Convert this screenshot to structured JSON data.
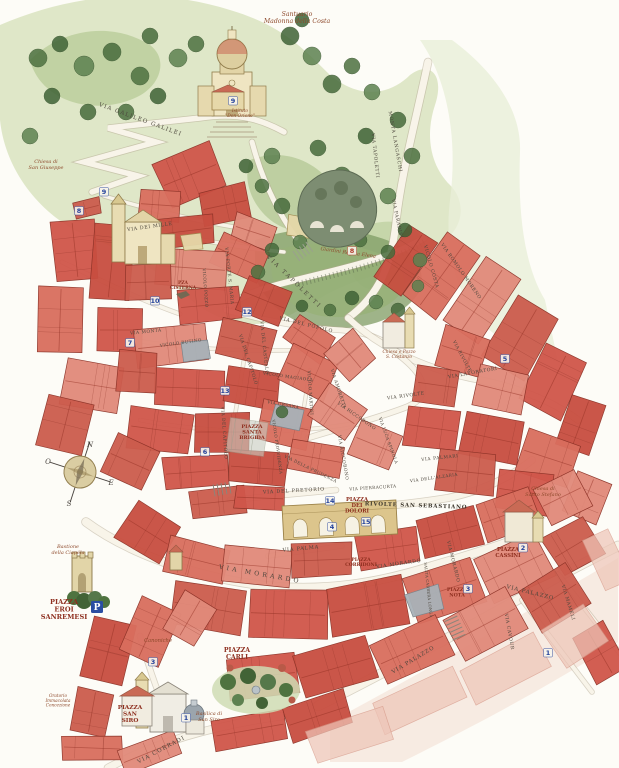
{
  "map": {
    "compass": {
      "n": "N",
      "e": "E",
      "s": "S",
      "w": "O"
    },
    "parking": {
      "label": "P",
      "x": 97,
      "y": 607
    },
    "colors": {
      "building_red": "#d0564a",
      "building_outline": "#8c3227",
      "hill_green": "#b9cc96",
      "tree_green": "#4d7140",
      "road_cream": "#f8f4e9",
      "marker_blue": "#24439c",
      "marker_red": "#b23a2a",
      "piazza_red": "#8e2f1f",
      "landmark_brown": "#8e4a2c",
      "paper": "#fdfcf7"
    },
    "streets": [
      {
        "name": "VIA GALILEO GALILEI",
        "x": 140,
        "y": 121,
        "rot": 20,
        "size": 5.6,
        "ls": 1.2
      },
      {
        "name": "MONTA LANGASCHI",
        "x": 394,
        "y": 142,
        "rot": 80,
        "size": 4.6,
        "ls": 0.8
      },
      {
        "name": "VIA TAPOLETTI",
        "x": 374,
        "y": 156,
        "rot": 84,
        "size": 4.6,
        "ls": 0.6
      },
      {
        "name": "VIA PARADISI",
        "x": 396,
        "y": 219,
        "rot": 78,
        "size": 4.6,
        "ls": 0.6
      },
      {
        "name": "VIA DEI MILLE",
        "x": 150,
        "y": 228,
        "rot": -8,
        "size": 4.8,
        "ls": 0.6
      },
      {
        "name": "VIA TAPOLETTI",
        "x": 293,
        "y": 283,
        "rot": 44,
        "size": 5.6,
        "ls": 2.2
      },
      {
        "name": "VIA DEL POPOLO",
        "x": 306,
        "y": 326,
        "rot": 14,
        "size": 4.8,
        "ls": 0.8
      },
      {
        "name": "VIA PORTE S. MARIA",
        "x": 228,
        "y": 276,
        "rot": 84,
        "size": 4.4,
        "ls": 0.5
      },
      {
        "name": "VICOLO POZZO",
        "x": 204,
        "y": 288,
        "rot": 86,
        "size": 4.2,
        "ls": 0.4
      },
      {
        "name": "VIA MONTÀ",
        "x": 146,
        "y": 333,
        "rot": -6,
        "size": 4.4,
        "ls": 0.5
      },
      {
        "name": "VICOLO BUTINO",
        "x": 181,
        "y": 344,
        "rot": -8,
        "size": 4.2,
        "ls": 0.4
      },
      {
        "name": "VIA DEL CASTELLO",
        "x": 263,
        "y": 348,
        "rot": 84,
        "size": 4.4,
        "ls": 0.5
      },
      {
        "name": "VIA DEL CAPITOLO",
        "x": 247,
        "y": 360,
        "rot": 72,
        "size": 4.4,
        "ls": 0.5
      },
      {
        "name": "VIA DEL CAPITOLO",
        "x": 223,
        "y": 433,
        "rot": 86,
        "size": 4.4,
        "ls": 0.5
      },
      {
        "name": "VICOLO MAGIAOLA",
        "x": 288,
        "y": 378,
        "rot": 8,
        "size": 4.2,
        "ls": 0.5
      },
      {
        "name": "VIA AMORETTI",
        "x": 337,
        "y": 389,
        "rot": 72,
        "size": 4.4,
        "ls": 0.5
      },
      {
        "name": "VICOLO MARTINI",
        "x": 309,
        "y": 393,
        "rot": 86,
        "size": 4.2,
        "ls": 0.4
      },
      {
        "name": "VIA URSANA",
        "x": 283,
        "y": 406,
        "rot": 10,
        "size": 4.2,
        "ls": 0.4
      },
      {
        "name": "VIA RIVOLTE",
        "x": 406,
        "y": 397,
        "rot": -8,
        "size": 4.6,
        "ls": 0.6
      },
      {
        "name": "VIA RIVOLTE",
        "x": 461,
        "y": 357,
        "rot": 62,
        "size": 4.4,
        "ls": 0.5
      },
      {
        "name": "VIA LAVORATORI",
        "x": 473,
        "y": 374,
        "rot": -10,
        "size": 4.6,
        "ls": 0.6
      },
      {
        "name": "VICOLO COSTA",
        "x": 430,
        "y": 267,
        "rot": 74,
        "size": 4.6,
        "ls": 0.6
      },
      {
        "name": "VIA ROMOLO MORENO",
        "x": 460,
        "y": 272,
        "rot": 55,
        "size": 4.6,
        "ls": 0.6
      },
      {
        "name": "VIA RICCOBONO",
        "x": 356,
        "y": 417,
        "rot": 35,
        "size": 4.4,
        "ls": 0.5
      },
      {
        "name": "VIA RICCOBONO",
        "x": 342,
        "y": 458,
        "rot": 80,
        "size": 4.4,
        "ls": 0.5
      },
      {
        "name": "VIA PALMARI",
        "x": 440,
        "y": 459,
        "rot": -6,
        "size": 4.4,
        "ls": 0.6
      },
      {
        "name": "VIA DELL'ALZARIA",
        "x": 434,
        "y": 479,
        "rot": -8,
        "size": 4.2,
        "ls": 0.4
      },
      {
        "name": "VIA PIERRACURTA",
        "x": 373,
        "y": 489,
        "rot": -4,
        "size": 4.2,
        "ls": 0.4
      },
      {
        "name": "VIA DELLA PRUDENZA",
        "x": 310,
        "y": 470,
        "rot": 26,
        "size": 4.2,
        "ls": 0.4
      },
      {
        "name": "VICOLO PROVVIDENZA",
        "x": 276,
        "y": 447,
        "rot": 82,
        "size": 4.0,
        "ls": 0.3
      },
      {
        "name": "VIA LUCA SPINOLA",
        "x": 387,
        "y": 441,
        "rot": 70,
        "size": 4.2,
        "ls": 0.4
      },
      {
        "name": "VIA DEL PRETORIO",
        "x": 294,
        "y": 492,
        "rot": -3,
        "size": 4.8,
        "ls": 0.8
      },
      {
        "name": "RIVOLTE SAN SEBASTIANO",
        "x": 416,
        "y": 507,
        "rot": 2,
        "size": 5.4,
        "ls": 0.8,
        "bold": true
      },
      {
        "name": "VIA PALMA",
        "x": 301,
        "y": 550,
        "rot": -5,
        "size": 5.0,
        "ls": 0.8
      },
      {
        "name": "VIA MORARDO",
        "x": 260,
        "y": 576,
        "rot": 10,
        "size": 6.2,
        "ls": 3.2
      },
      {
        "name": "VIA MORARDO",
        "x": 399,
        "y": 565,
        "rot": -8,
        "size": 4.8,
        "ls": 0.7
      },
      {
        "name": "VIA MORARDO",
        "x": 452,
        "y": 562,
        "rot": 76,
        "size": 4.6,
        "ls": 0.6
      },
      {
        "name": "SALITA CARRERA LONGA",
        "x": 427,
        "y": 590,
        "rot": 84,
        "size": 3.8,
        "ls": 0.2
      },
      {
        "name": "VIA PALAZZO",
        "x": 530,
        "y": 594,
        "rot": 14,
        "size": 5.4,
        "ls": 1.0
      },
      {
        "name": "VIA PALAZZO",
        "x": 414,
        "y": 661,
        "rot": -31,
        "size": 5.4,
        "ls": 1.0
      },
      {
        "name": "VIA CAVOUR",
        "x": 508,
        "y": 632,
        "rot": 80,
        "size": 4.6,
        "ls": 0.6
      },
      {
        "name": "VIA MAMELI",
        "x": 567,
        "y": 603,
        "rot": 73,
        "size": 4.6,
        "ls": 0.6
      },
      {
        "name": "VIA CORRADI",
        "x": 162,
        "y": 751,
        "rot": -28,
        "size": 5.6,
        "ls": 1.2
      }
    ],
    "piazzas": [
      {
        "lines": [
          "PZA",
          "CISTERNA"
        ],
        "x": 183,
        "y": 284,
        "size": 4.4
      },
      {
        "lines": [
          "PIAZZA",
          "SANTA",
          "BRIGIDA"
        ],
        "x": 252,
        "y": 428,
        "size": 5.0
      },
      {
        "lines": [
          "PIAZZA",
          "DEI",
          "DOLORI"
        ],
        "x": 357,
        "y": 501,
        "size": 5.2
      },
      {
        "lines": [
          "PIAZZA",
          "CORRIDONI"
        ],
        "x": 361,
        "y": 561,
        "size": 4.6
      },
      {
        "lines": [
          "PIAZZA",
          "NOTA"
        ],
        "x": 457,
        "y": 591,
        "size": 4.8
      },
      {
        "lines": [
          "PIAZZA",
          "CASSINI"
        ],
        "x": 508,
        "y": 551,
        "size": 5.2
      },
      {
        "lines": [
          "PIAZZA",
          "EROI",
          "SANREMESI"
        ],
        "x": 64,
        "y": 604,
        "size": 6.6
      },
      {
        "lines": [
          "PIAZZA",
          "CARLI"
        ],
        "x": 237,
        "y": 652,
        "size": 6.2
      },
      {
        "lines": [
          "PIAZZA",
          "SAN",
          "SIRO"
        ],
        "x": 130,
        "y": 709,
        "size": 5.8
      }
    ],
    "landmarks": [
      {
        "lines": [
          "Santuario",
          "Madonna della Costa"
        ],
        "x": 297,
        "y": 16,
        "size": 6.2
      },
      {
        "lines": [
          "Istituto",
          "\"Don Orione\""
        ],
        "x": 240,
        "y": 112,
        "size": 4.4
      },
      {
        "lines": [
          "Chiesa di",
          "San Giuseppe"
        ],
        "x": 46,
        "y": 163,
        "size": 5.0
      },
      {
        "lines": [
          "Giardini Regina Elena"
        ],
        "x": 348,
        "y": 254,
        "size": 5.0,
        "rot": 8
      },
      {
        "lines": [
          "Chiesa e Pozzo",
          "S. Costanzo"
        ],
        "x": 399,
        "y": 353,
        "size": 4.4
      },
      {
        "lines": [
          "Chiesa di",
          "Santo Stefano"
        ],
        "x": 543,
        "y": 490,
        "size": 5.0
      },
      {
        "lines": [
          "Bastione",
          "della Ciapéla"
        ],
        "x": 68,
        "y": 548,
        "size": 5.0
      },
      {
        "lines": [
          "Canoniche"
        ],
        "x": 158,
        "y": 642,
        "size": 5.2
      },
      {
        "lines": [
          "Oratorio",
          "Immacolata",
          "Concezione"
        ],
        "x": 58,
        "y": 697,
        "size": 4.2
      },
      {
        "lines": [
          "Basilica di",
          "San Siro"
        ],
        "x": 209,
        "y": 715,
        "size": 5.0
      }
    ],
    "markers": [
      {
        "n": "9",
        "x": 233,
        "y": 103
      },
      {
        "n": "8",
        "x": 79,
        "y": 213
      },
      {
        "n": "9",
        "x": 104,
        "y": 194
      },
      {
        "n": "10",
        "x": 155,
        "y": 303
      },
      {
        "n": "12",
        "x": 247,
        "y": 314
      },
      {
        "n": "7",
        "x": 130,
        "y": 345
      },
      {
        "n": "13",
        "x": 225,
        "y": 393
      },
      {
        "n": "6",
        "x": 205,
        "y": 454
      },
      {
        "n": "5",
        "x": 505,
        "y": 361
      },
      {
        "n": "8",
        "x": 352,
        "y": 253,
        "red": true
      },
      {
        "n": "14",
        "x": 330,
        "y": 503
      },
      {
        "n": "4",
        "x": 332,
        "y": 529
      },
      {
        "n": "15",
        "x": 366,
        "y": 524
      },
      {
        "n": "2",
        "x": 523,
        "y": 550
      },
      {
        "n": "3",
        "x": 468,
        "y": 591
      },
      {
        "n": "3",
        "x": 153,
        "y": 664
      },
      {
        "n": "1",
        "x": 548,
        "y": 655
      },
      {
        "n": "1",
        "x": 186,
        "y": 720
      }
    ]
  }
}
